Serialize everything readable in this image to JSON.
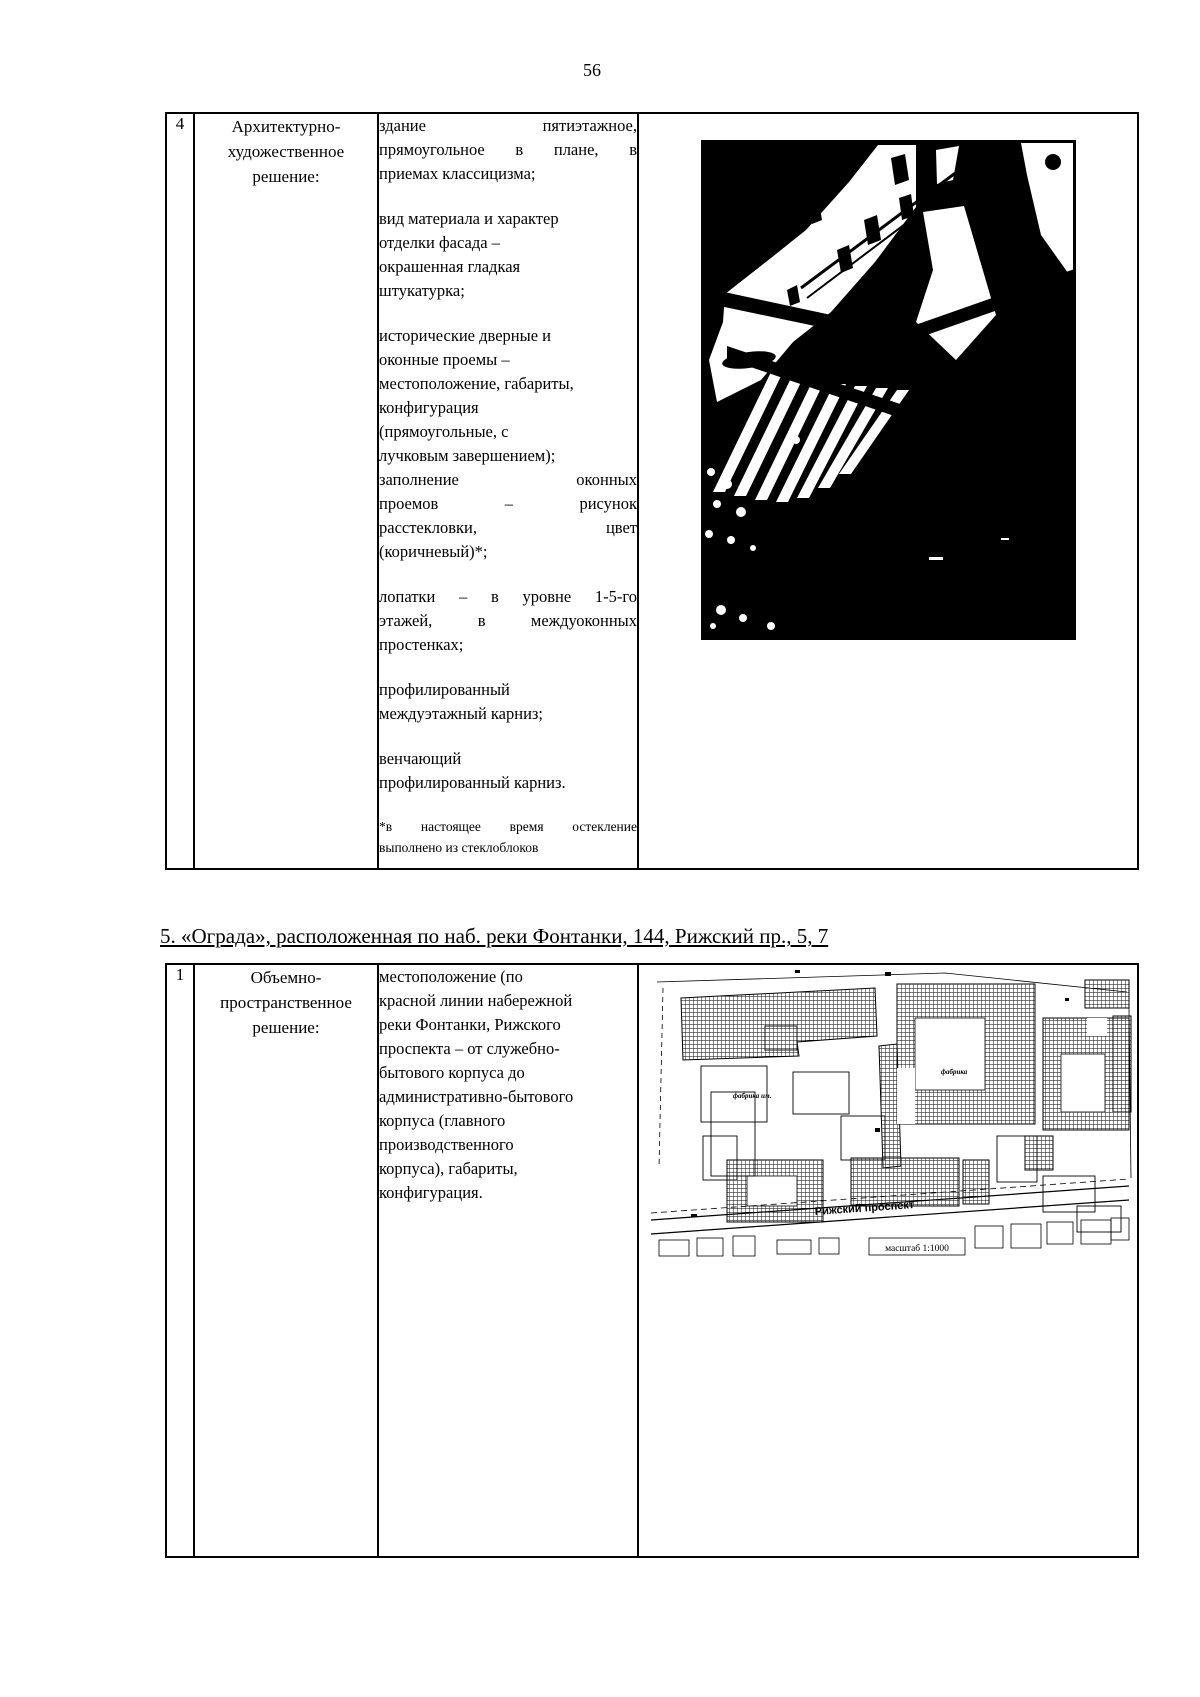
{
  "page": {
    "number": "56"
  },
  "colors": {
    "ink": "#000000",
    "paper": "#ffffff"
  },
  "table1": {
    "row_number": "4",
    "label_lines": [
      "Архитектурно-",
      "художественное",
      "решение:"
    ],
    "paragraphs": [
      {
        "lines": [
          {
            "t": "здание пятиэтажное,",
            "j": 1
          },
          {
            "t": "прямоугольное в плане, в",
            "j": 1
          },
          "приемах классицизма;"
        ]
      },
      {
        "lines": [
          "вид материала и характер",
          "отделки фасада –",
          "окрашенная гладкая",
          "штукатурка;"
        ]
      },
      {
        "lines": [
          "исторические дверные и",
          "оконные проемы –",
          "местоположение, габариты,",
          "конфигурация",
          "(прямоугольные, с",
          "лучковым завершением);",
          {
            "t": "заполнение оконных",
            "j": 1
          },
          {
            "t": "проемов – рисунок",
            "j": 1
          },
          {
            "t": "расстекловки, цвет",
            "j": 1
          },
          "(коричневый)*;"
        ]
      },
      {
        "lines": [
          {
            "t": "лопатки – в уровне 1-5-го",
            "j": 1
          },
          {
            "t": "этажей, в междуоконных",
            "j": 1
          },
          "простенках;"
        ]
      },
      {
        "lines": [
          "профилированный",
          "междуэтажный карниз;"
        ]
      },
      {
        "lines": [
          "венчающий",
          "профилированный карниз."
        ]
      }
    ],
    "footnote_lines": [
      {
        "t": "*в настоящее время остекление",
        "j": 1
      },
      "выполнено из стеклоблоков"
    ]
  },
  "section_heading": "5. «Ограда», расположенная по наб. реки Фонтанки, 144, Рижский пр., 5, 7",
  "table2": {
    "row_number": "1",
    "label_lines": [
      "Объемно-",
      "пространственное",
      "решение:"
    ],
    "paragraph_lines": [
      "местоположение (по",
      "красной линии набережной",
      "реки Фонтанки, Рижского",
      "проспекта – от служебно-",
      "бытового корпуса до",
      "административно-бытового",
      "корпуса (главного",
      "производственного",
      "корпуса), габариты,",
      "конфигурация."
    ],
    "map": {
      "street_label": "Рижский проспект",
      "scale_label": "масштаб 1:1000",
      "building_label_left": "фабрика им.",
      "building_label_center": "фабрика"
    }
  }
}
